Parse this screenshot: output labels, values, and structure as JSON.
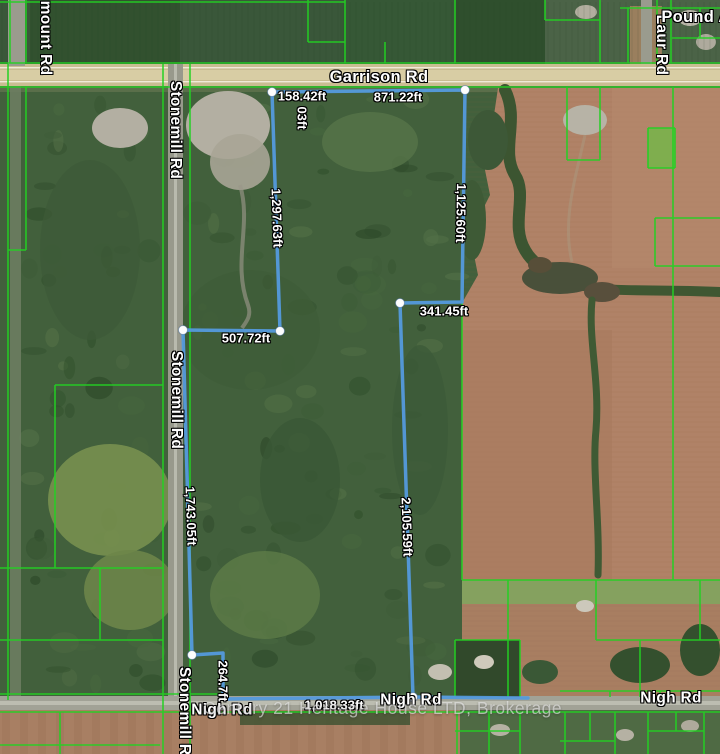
{
  "road_labels": [
    {
      "name": "garrison-rd",
      "text": "Garrison Rd"
    },
    {
      "name": "stonemill-rd-top",
      "text": "Stonemill Rd"
    },
    {
      "name": "stonemill-rd-mid",
      "text": "Stonemill Rd"
    },
    {
      "name": "stonemill-rd-bottom",
      "text": "Stonemill Rd"
    },
    {
      "name": "nigh-rd-left",
      "text": "Nigh Rd"
    },
    {
      "name": "nigh-rd-mid",
      "text": "Nigh Rd"
    },
    {
      "name": "nigh-rd-right",
      "text": "Nigh Rd"
    },
    {
      "name": "mount-rd-partial",
      "text": "mount Rd"
    },
    {
      "name": "laur-rd",
      "text": "Laur Rd"
    },
    {
      "name": "pound-rd-partial",
      "text": "Pound A"
    }
  ],
  "measurements": [
    {
      "segment": "garrison-frontage-west",
      "text": "158.42ft"
    },
    {
      "segment": "garrison-frontage-east",
      "text": "871.22ft"
    },
    {
      "segment": "hidden-partial",
      "text": "03ft"
    },
    {
      "segment": "west-upper-side",
      "text": "1,297.63ft"
    },
    {
      "segment": "east-upper-side",
      "text": "1,125.60ft"
    },
    {
      "segment": "east-jog",
      "text": "341.45ft"
    },
    {
      "segment": "west-jog",
      "text": "507.72ft"
    },
    {
      "segment": "stonemill-side",
      "text": "1,743.05ft"
    },
    {
      "segment": "east-lower-side",
      "text": "2,105.59ft"
    },
    {
      "segment": "south-jog",
      "text": "264.7ft"
    },
    {
      "segment": "nigh-frontage",
      "text": "1,018.33ft"
    }
  ],
  "watermark": {
    "text": "Century 21 Heritage House LTD, Brokerage"
  },
  "colors": {
    "boundary_line": "#549add",
    "parcel_line": "#23d123",
    "label_text": "#ffffff",
    "road_fill_major": "#cfc49b",
    "road_fill_minor": "#a1a296",
    "farmland": "#b08267",
    "forest": "#42603c"
  }
}
